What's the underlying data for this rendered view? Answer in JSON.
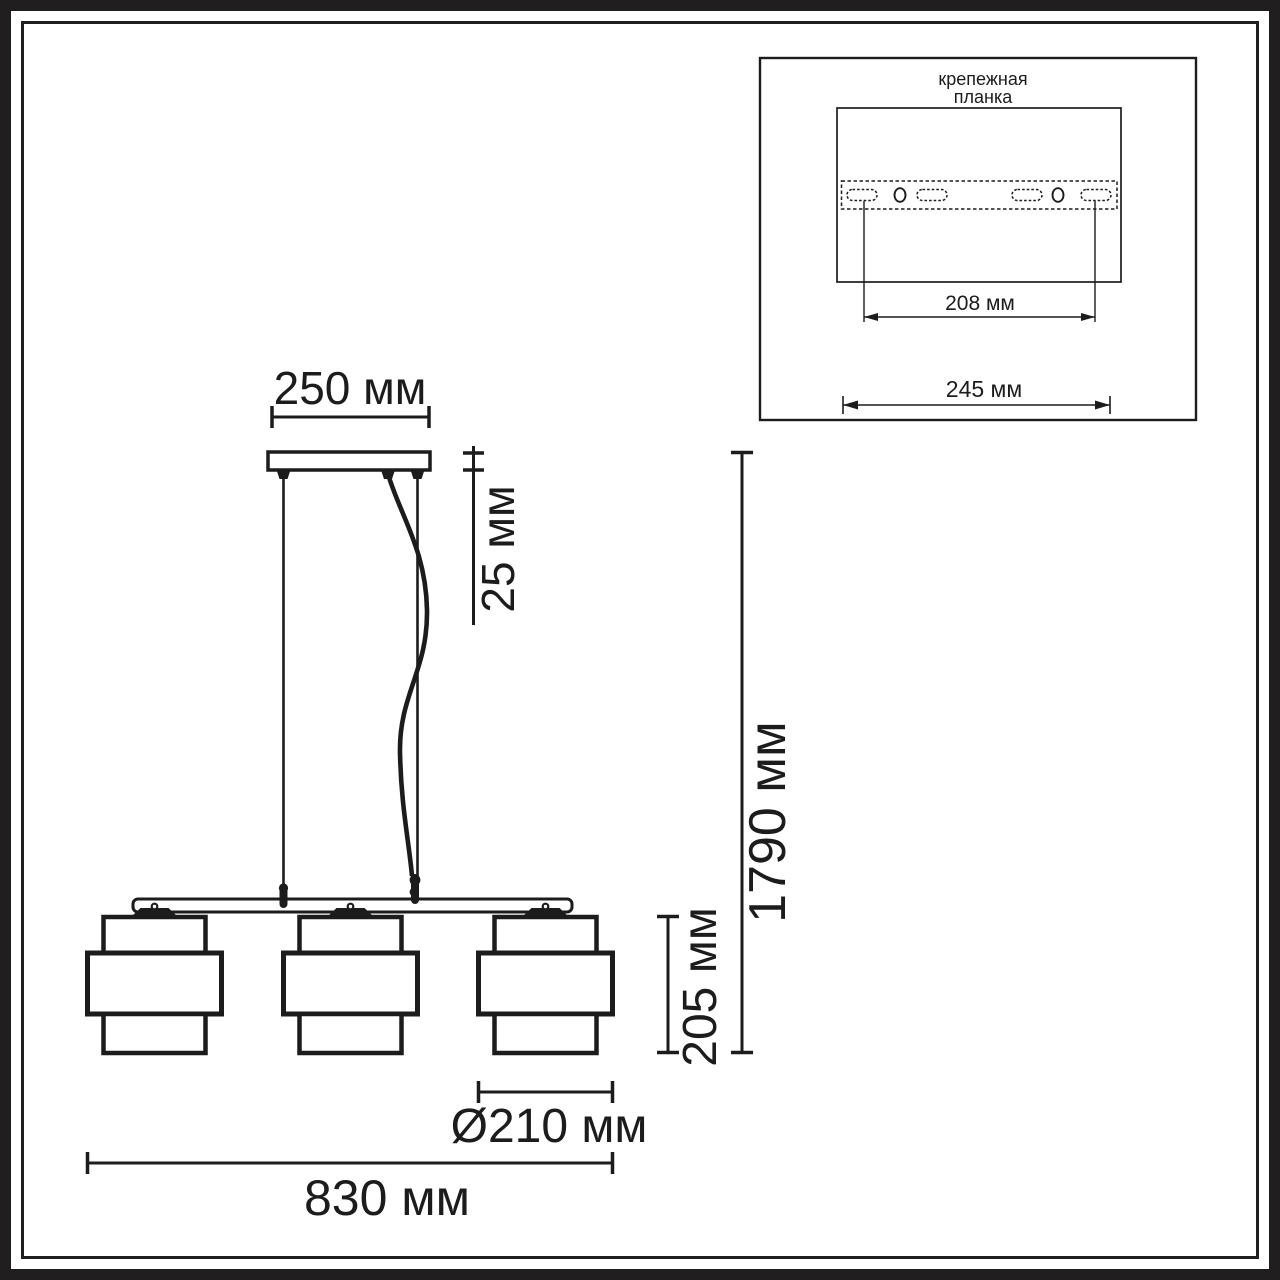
{
  "main_drawing": {
    "canopy_width_label": "250 мм",
    "canopy_height_label": "25 мм",
    "overall_height_label": "1790 мм",
    "shade_height_label": "205 мм",
    "shade_diameter_label": "Ø210 мм",
    "overall_length_label": "830 мм",
    "shade_count": 3
  },
  "inset": {
    "title_line1": "крепежная",
    "title_line2": "планка",
    "holes_spacing_label": "208 мм",
    "plate_width_label": "245 мм"
  },
  "colors": {
    "line": "#1c1c1c",
    "frame": "#201e1e",
    "background": "#ffffff"
  }
}
